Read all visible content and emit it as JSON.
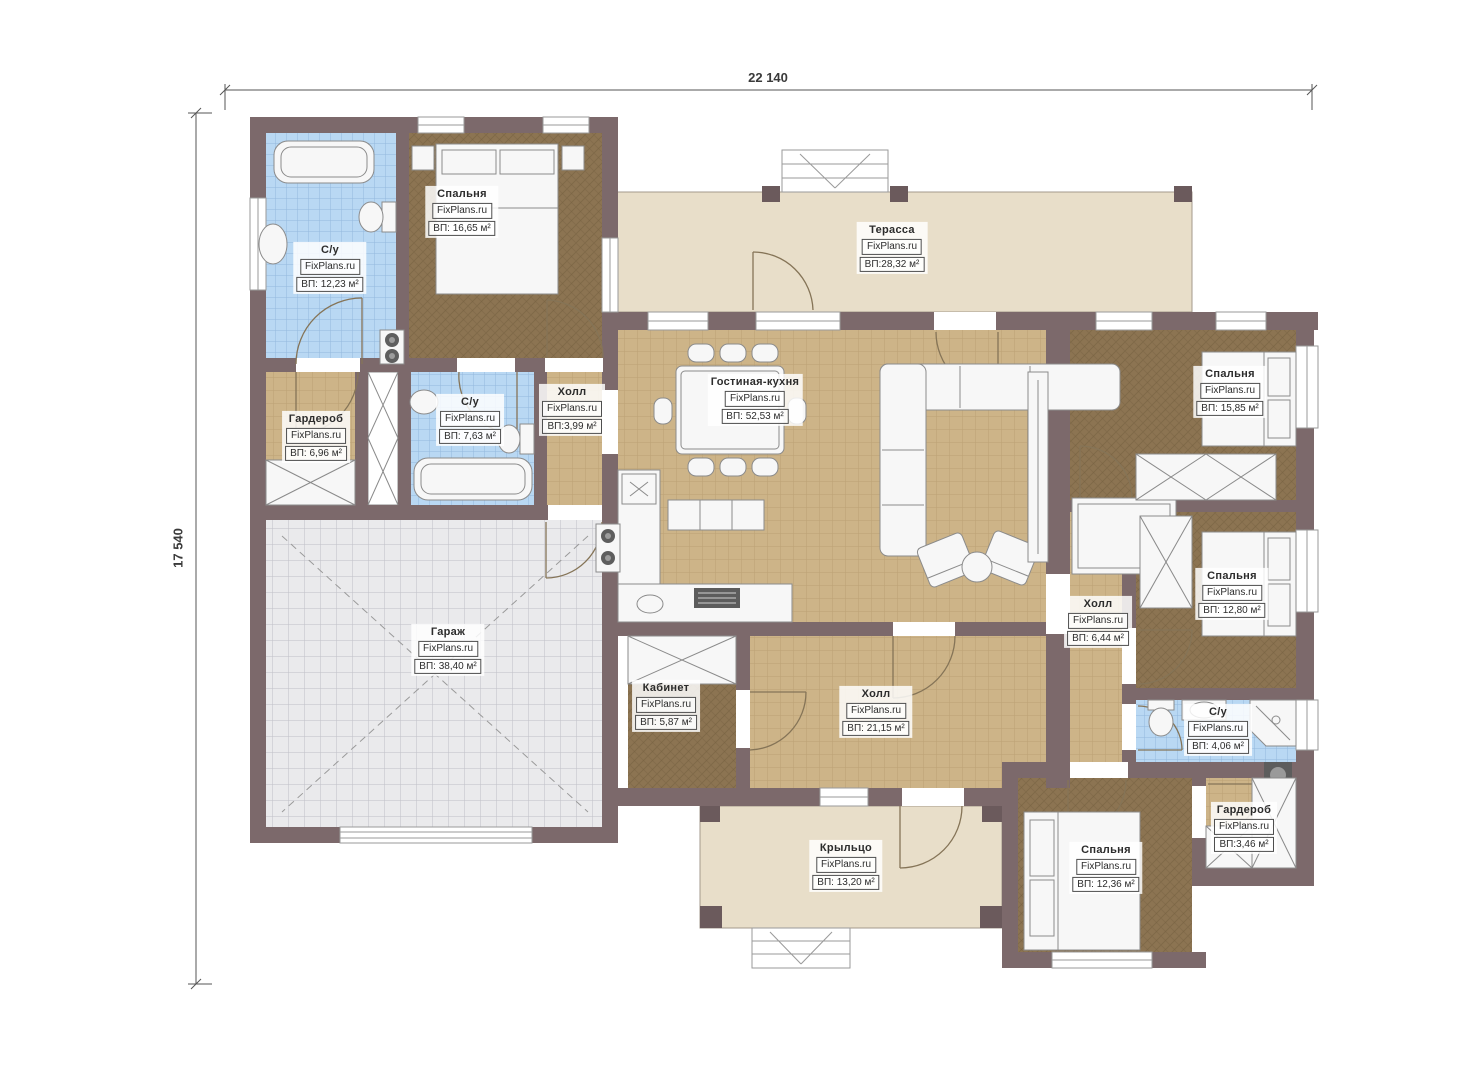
{
  "watermark": {
    "text": "FixPlans.ru"
  },
  "dimensions": {
    "width": "22 140",
    "height": "17 540"
  },
  "colors": {
    "wall": "#7c696b",
    "bedroom_floor": "#8c7452",
    "hall_floor": "#cdb488",
    "bathroom_floor": "#b9d8f3",
    "terrace_floor": "#e8dec9",
    "garage_floor": "#eaeaec"
  },
  "rooms": [
    {
      "name": "С/у",
      "area": "ВП: 12,23 м²"
    },
    {
      "name": "Спальня",
      "area": "ВП: 16,65 м²"
    },
    {
      "name": "Терасса",
      "area": "ВП:28,32 м²"
    },
    {
      "name": "Гардероб",
      "area": "ВП: 6,96 м²"
    },
    {
      "name": "С/у",
      "area": "ВП: 7,63 м²"
    },
    {
      "name": "Холл",
      "area": "ВП:3,99 м²"
    },
    {
      "name": "Гостиная-кухня",
      "area": "ВП: 52,53 м²"
    },
    {
      "name": "Спальня",
      "area": "ВП: 15,85 м²"
    },
    {
      "name": "Спальня",
      "area": "ВП: 12,80 м²"
    },
    {
      "name": "Холл",
      "area": "ВП: 6,44 м²"
    },
    {
      "name": "Гараж",
      "area": "ВП: 38,40 м²"
    },
    {
      "name": "Кабинет",
      "area": "ВП: 5,87 м²"
    },
    {
      "name": "Холл",
      "area": "ВП: 21,15 м²"
    },
    {
      "name": "С/у",
      "area": "ВП: 4,06 м²"
    },
    {
      "name": "Гардероб",
      "area": "ВП:3,46 м²"
    },
    {
      "name": "Спальня",
      "area": "ВП: 12,36 м²"
    },
    {
      "name": "Крыльцо",
      "area": "ВП: 13,20 м²"
    }
  ]
}
